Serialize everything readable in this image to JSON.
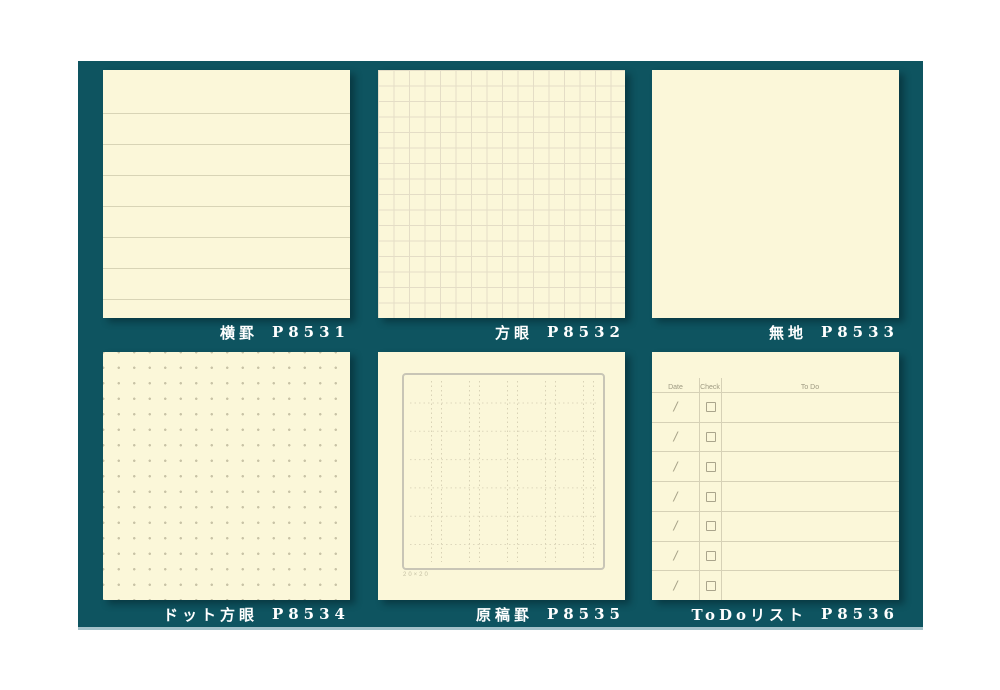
{
  "board": {
    "bg": "#0e5460",
    "bottom_strip": "#a4c2ca",
    "paper": "#fbf7d9"
  },
  "products": [
    {
      "id": "ruled",
      "name": "横罫",
      "code": "P8531",
      "pattern": "horizontal-ruled"
    },
    {
      "id": "grid",
      "name": "方眼",
      "code": "P8532",
      "pattern": "square-grid"
    },
    {
      "id": "plain",
      "name": "無地",
      "code": "P8533",
      "pattern": "plain"
    },
    {
      "id": "dot-grid",
      "name": "ドット方眼",
      "code": "P8534",
      "pattern": "dot-grid"
    },
    {
      "id": "manuscript",
      "name": "原稿罫",
      "code": "P8535",
      "pattern": "manuscript-frame",
      "footnote": "20×20"
    },
    {
      "id": "todo",
      "name": "ToDoリスト",
      "code": "P8536",
      "pattern": "todo-list",
      "todo": {
        "headers": [
          "Date",
          "Check",
          "To Do"
        ],
        "row_count": 7,
        "date_mark": "/"
      }
    }
  ]
}
